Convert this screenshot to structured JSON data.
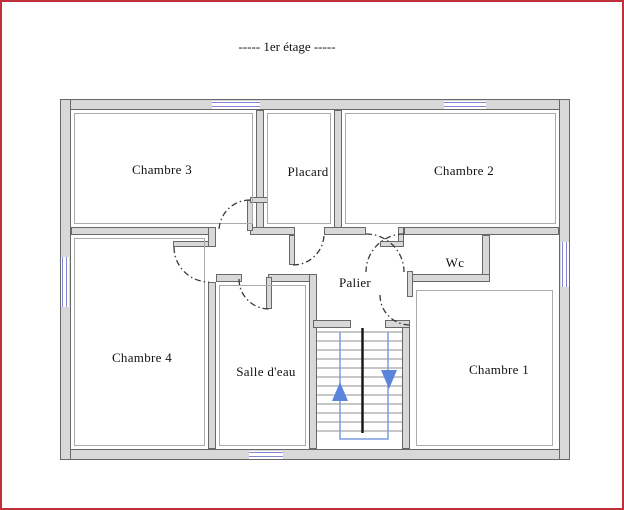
{
  "title": "-----  1er étage  -----",
  "plan": {
    "floor": "1er étage",
    "rooms": [
      {
        "name": "Chambre 3"
      },
      {
        "name": "Placard"
      },
      {
        "name": "Chambre 2"
      },
      {
        "name": "Wc"
      },
      {
        "name": "Palier"
      },
      {
        "name": "Chambre 4"
      },
      {
        "name": "Salle d'eau"
      },
      {
        "name": "Chambre 1"
      }
    ],
    "stairs": {
      "up_arrow": "up",
      "down_arrow": "down"
    },
    "window_count": 5,
    "door_count": 7
  },
  "colors": {
    "page_border": "#c0303a",
    "wall_fill": "#d8d8d8",
    "wall_edge": "#686868",
    "window_blue": "#8585d6",
    "stair_path_blue": "#7b9ce0",
    "arrow_blue": "#5b85dd",
    "door_arc": "#3a3a3a",
    "text": "#111111"
  }
}
